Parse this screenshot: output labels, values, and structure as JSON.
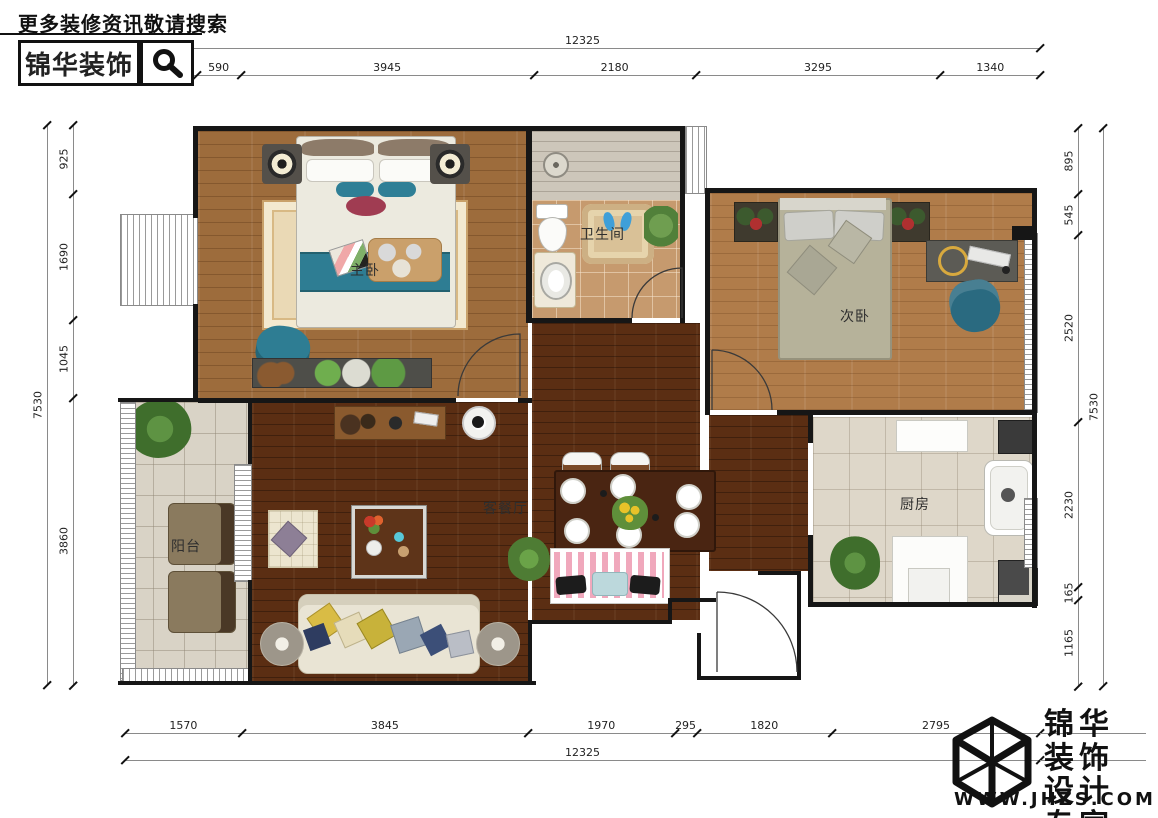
{
  "header": {
    "search_hint": "更多装修资讯敬请搜索",
    "brand": "锦华装饰",
    "search_icon": "magnifier"
  },
  "brand_footer": {
    "line1": "锦华装饰",
    "line2": "设计专家",
    "website": "WWW.JHZS.COM",
    "logo": "cube-wireframe"
  },
  "dimensions": {
    "top_total": "12325",
    "bottom_total": "12325",
    "left_total": "7530",
    "right_total": "7530",
    "top": [
      "965",
      "590",
      "3945",
      "2180",
      "3295",
      "1340"
    ],
    "bottom": [
      "1570",
      "3845",
      "1970",
      "295",
      "1820",
      "2795"
    ],
    "left": [
      "925",
      "1690",
      "1045",
      "3860"
    ],
    "right": [
      "895",
      "545",
      "2520",
      "2230",
      "165",
      "1165"
    ]
  },
  "rooms": {
    "master": "主卧",
    "bathroom": "卫生间",
    "second": "次卧",
    "living_dining": "客餐厅",
    "balcony": "阳台",
    "kitchen": "厨房"
  },
  "colors": {
    "accent_teal": "#2e7d93",
    "living_floor": "#5b2e13",
    "master_floor": "#9d6c3c",
    "second_floor": "#b07c4a",
    "balcony_tile": "#d9d3c6",
    "bath_tile": "#c69a6e",
    "dim_line_grey": "#8a8a8a",
    "wall_black": "#161616"
  }
}
